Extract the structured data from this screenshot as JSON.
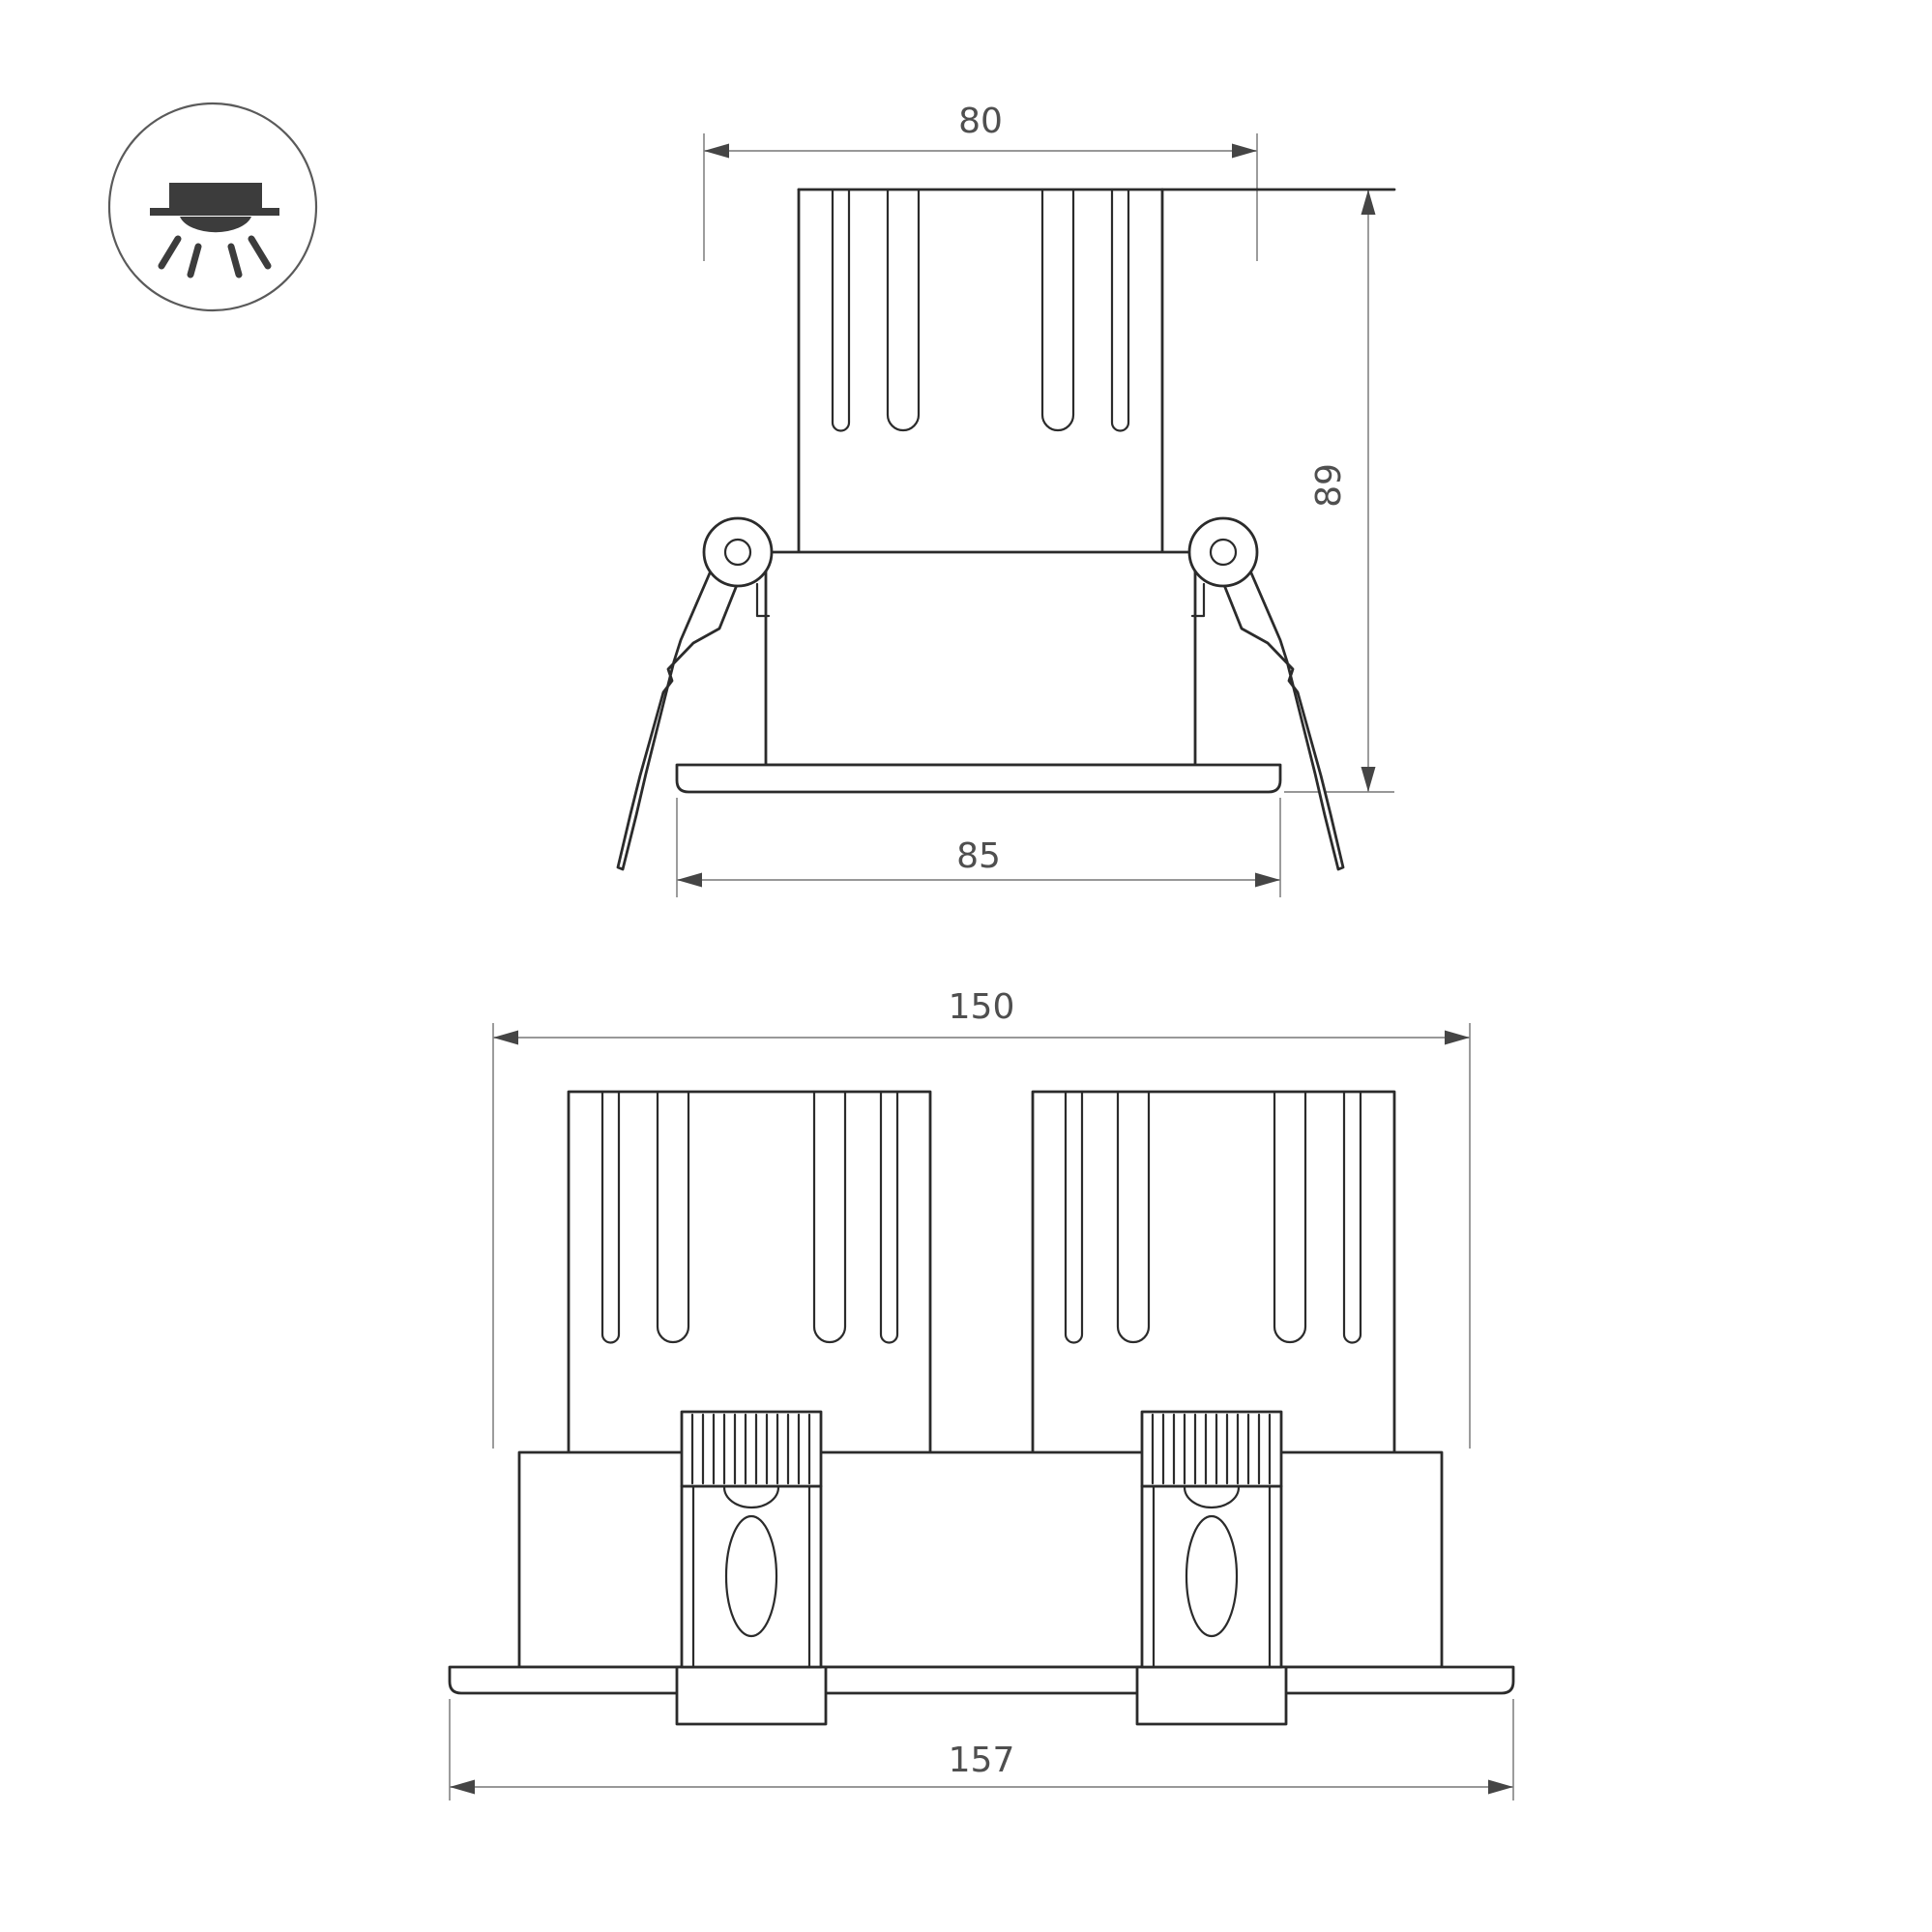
{
  "page": {
    "background": "#ffffff",
    "kind": "technical-dimension-drawing"
  },
  "icon": {
    "name": "recessed-downlight-icon"
  },
  "views": {
    "single": {
      "name": "single-lamp-front-view",
      "dims": {
        "width_top": "80",
        "height": "89",
        "width_flange": "85"
      }
    },
    "dual": {
      "name": "dual-lamp-front-view",
      "dims": {
        "width_body": "150",
        "width_flange": "157"
      }
    }
  },
  "colors": {
    "outline": "#2b2b2b",
    "dim": "#8a8a8a",
    "arrow": "#454545",
    "text": "#4f4f4f",
    "icon": "#3c3c3c"
  }
}
